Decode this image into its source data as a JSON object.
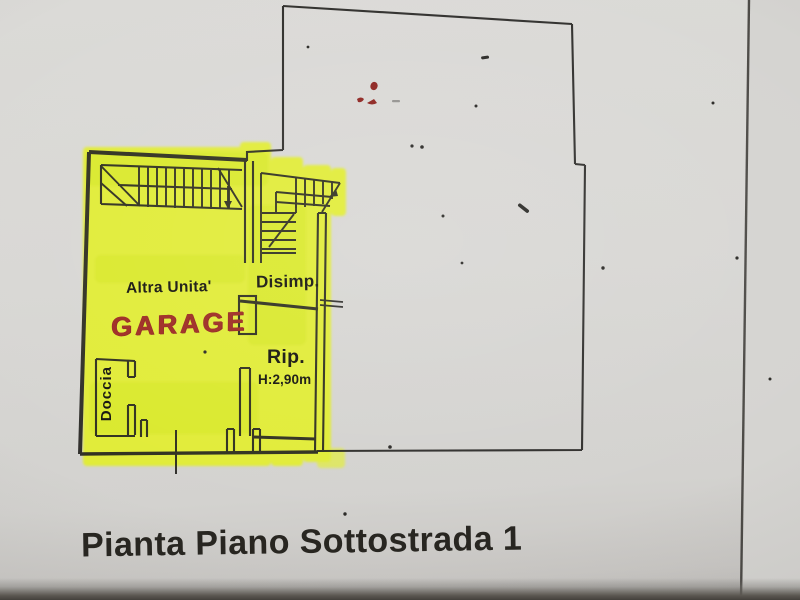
{
  "document": {
    "type_note": "scanned floor plan photo",
    "caption": "Pianta Piano Sottostrada 1",
    "labels": {
      "altra_unita": "Altra Unita'",
      "garage": "GARAGE",
      "disimp": "Disimp.",
      "rip": "Rip.",
      "rip_height": "H:2,90m",
      "doccia": "Doccia"
    },
    "colors": {
      "highlight_yellow": "#e2ee2f",
      "marker_red": "#9e2b22",
      "ink_black": "#23221f",
      "paper_gray": "#d7d6d3"
    }
  }
}
